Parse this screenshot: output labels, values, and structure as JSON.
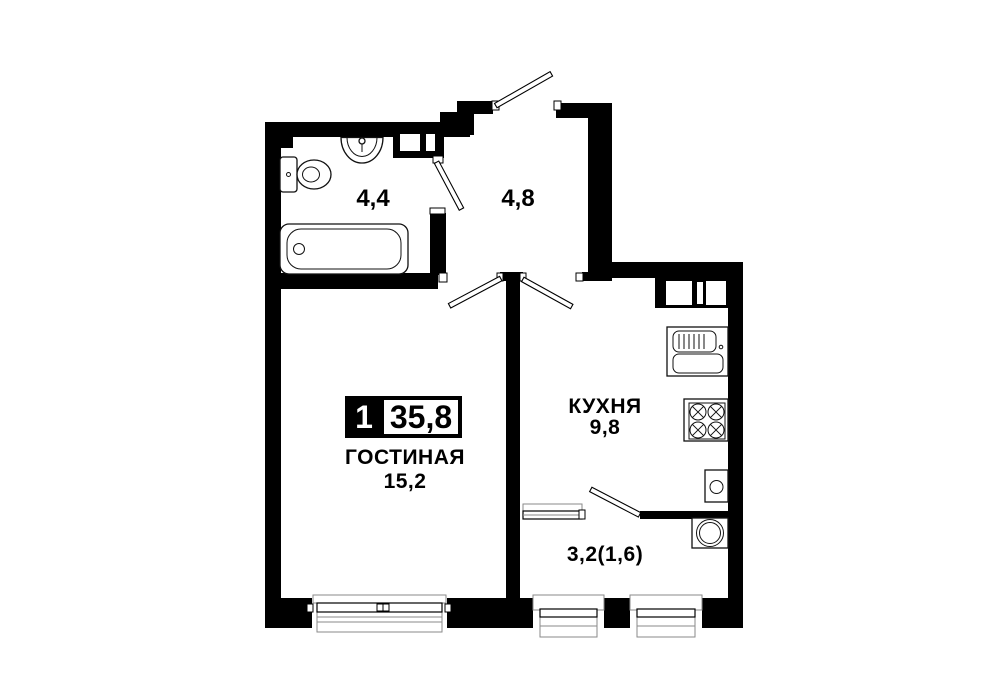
{
  "badge": {
    "rooms_count": "1",
    "total_area": "35,8"
  },
  "rooms": {
    "bathroom": {
      "area": "4,4"
    },
    "hall": {
      "area": "4,8"
    },
    "living": {
      "name": "ГОСТИНАЯ",
      "area": "15,2"
    },
    "kitchen": {
      "name": "КУХНЯ",
      "area": "9,8"
    },
    "balcony": {
      "area": "3,2(1,6)"
    }
  },
  "fixtures": [
    "toilet",
    "washbasin",
    "bathtub",
    "kitchen-sink",
    "stove",
    "washing-machine",
    "water-heater",
    "ventilation-shaft"
  ],
  "colors": {
    "wall": "#000000",
    "background": "#ffffff",
    "detail_line": "#8a8a8a"
  }
}
